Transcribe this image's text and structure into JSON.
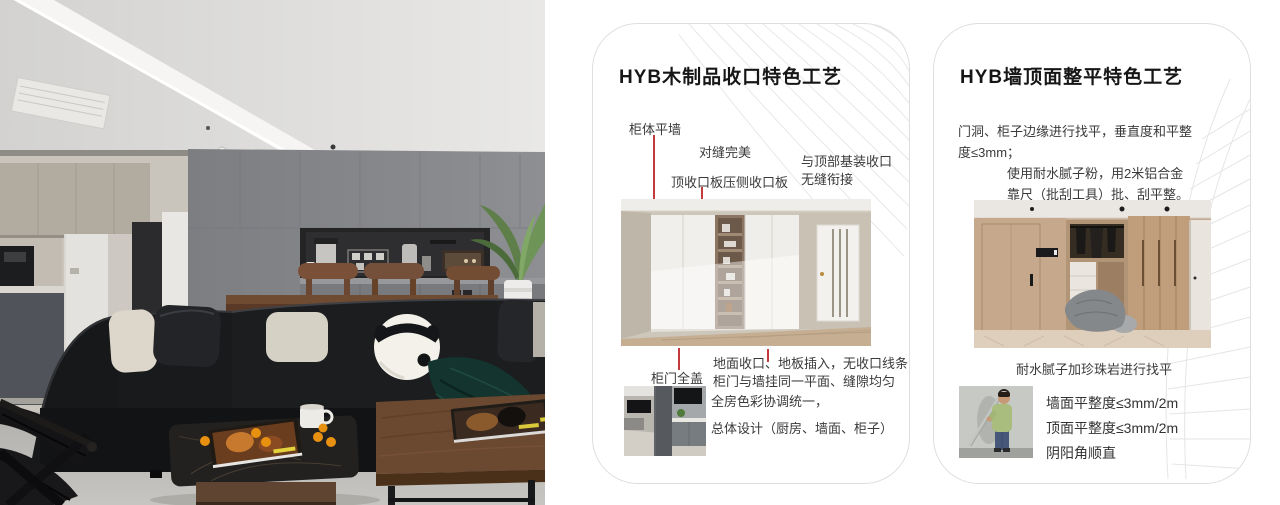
{
  "colors": {
    "accent_red": "#c43a3c",
    "card_border": "#dedede",
    "title_text": "#161616",
    "body_text": "#3a3a3a"
  },
  "card1": {
    "title": "HYB木制品收口特色工艺",
    "label_cabinet_flush_wall": "柜体平墙",
    "label_perfect_seam": "对缝完美",
    "label_top_closing_board": "顶收口板压侧收口板",
    "label_top_joint_line1": "与顶部基装收口",
    "label_top_joint_line2": "无缝衔接",
    "label_full_cover_door": "柜门全盖",
    "note_floor_line1": "地面收口、地板插入，无收口线条",
    "note_floor_line2": "柜门与墙挂同一平面、缝隙均匀",
    "note_color_line1": "全房色彩协调统一，",
    "note_color_line2": "总体设计（厨房、墙面、柜子）"
  },
  "card2": {
    "title": "HYB墙顶面整平特色工艺",
    "para1_line1": "门洞、柜子边缘进行找平，垂直度和平整",
    "para1_line2": "度≤3mm；",
    "para2_line1": "使用耐水腻子粉，用2米铝合金",
    "para2_line2": "靠尺（批刮工具）批、刮平整。",
    "caption": "耐水腻子加珍珠岩进行找平",
    "spec_wall": "墙面平整度≤3mm/2m",
    "spec_ceiling": "顶面平整度≤3mm/2m",
    "spec_corner": "阴阳角顺直"
  }
}
